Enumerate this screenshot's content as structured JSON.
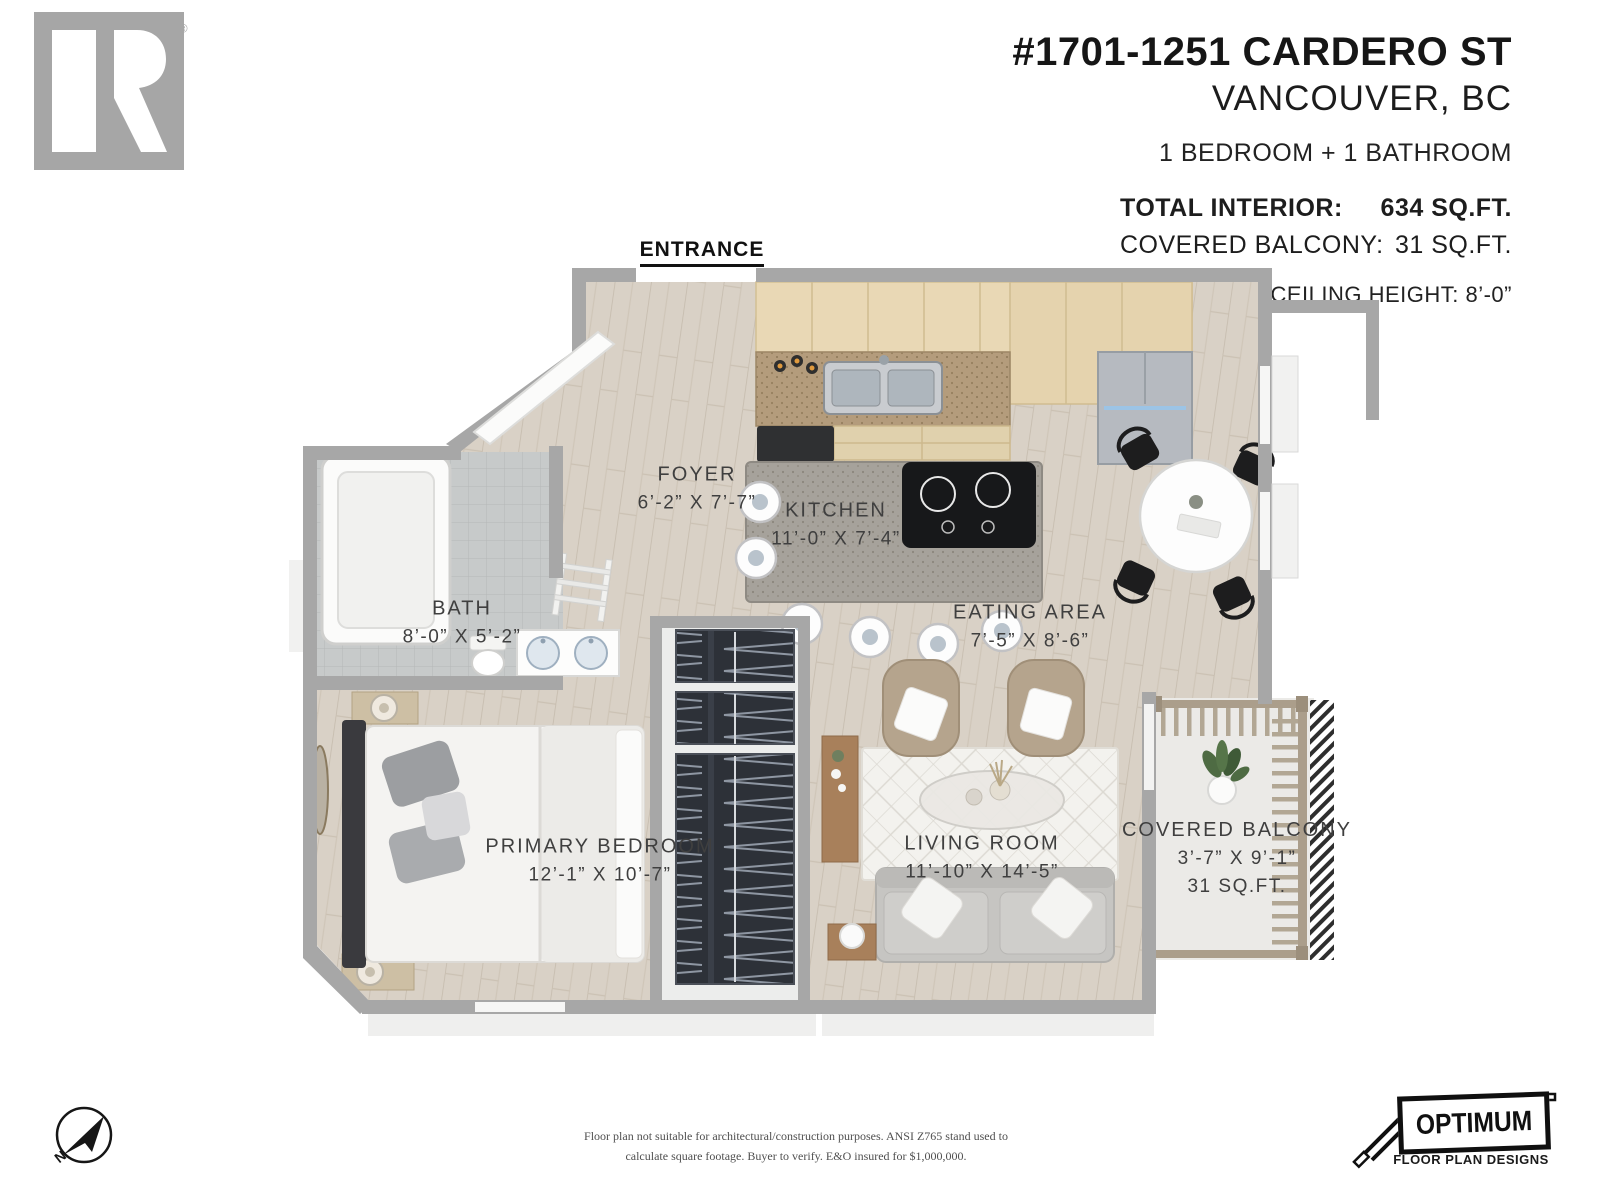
{
  "header": {
    "title": "#1701-1251 CARDERO ST",
    "city": "VANCOUVER, BC",
    "bedrooms_bathrooms": "1 BEDROOM + 1 BATHROOM",
    "total_interior_label": "TOTAL INTERIOR:",
    "total_interior_value": "634 SQ.FT.",
    "covered_balcony_label": "COVERED BALCONY:",
    "covered_balcony_value": "31 SQ.FT.",
    "ceiling_height": "CEILING HEIGHT: 8’-0”"
  },
  "branding": {
    "realtor_logo_text": "REALTOR",
    "realtor_registered_mark": "®",
    "optimum_name": "OPTIMUM",
    "optimum_tagline": "FLOOR PLAN DESIGNS"
  },
  "plan": {
    "entrance_label": "ENTRANCE",
    "compass_label": "N",
    "rooms": [
      {
        "name": "FOYER",
        "dimensions": "6’-2” X 7’-7”"
      },
      {
        "name": "KITCHEN",
        "dimensions": "11’-0” X 7’-4”"
      },
      {
        "name": "BATH",
        "dimensions": "8’-0” X 5’-2”"
      },
      {
        "name": "EATING AREA",
        "dimensions": "7’-5” X 8’-6”"
      },
      {
        "name": "PRIMARY BEDROOM",
        "dimensions": "12’-1” X 10’-7”"
      },
      {
        "name": "LIVING ROOM",
        "dimensions": "11’-10” X 14’-5”"
      },
      {
        "name": "COVERED BALCONY",
        "dimensions": "3’-7” X 9’-1”",
        "area": "31 SQ.FT."
      }
    ]
  },
  "footer": {
    "disclaimer_line1": "Floor plan not suitable for architectural/construction purposes. ANSI Z765 stand used to",
    "disclaimer_line2": "calculate square footage. Buyer to verify.  E&O insured for $1,000,000."
  },
  "colors": {
    "wall_gray": "#a7a7a7",
    "floor_wood": "#d9d1c6",
    "cabinet_tan": "#e9d8b5",
    "counter_brown": "#b49c7c",
    "label_text": "#3f3f3f",
    "realtor_gray": "#a6a6a6",
    "logo_black": "#101010"
  }
}
